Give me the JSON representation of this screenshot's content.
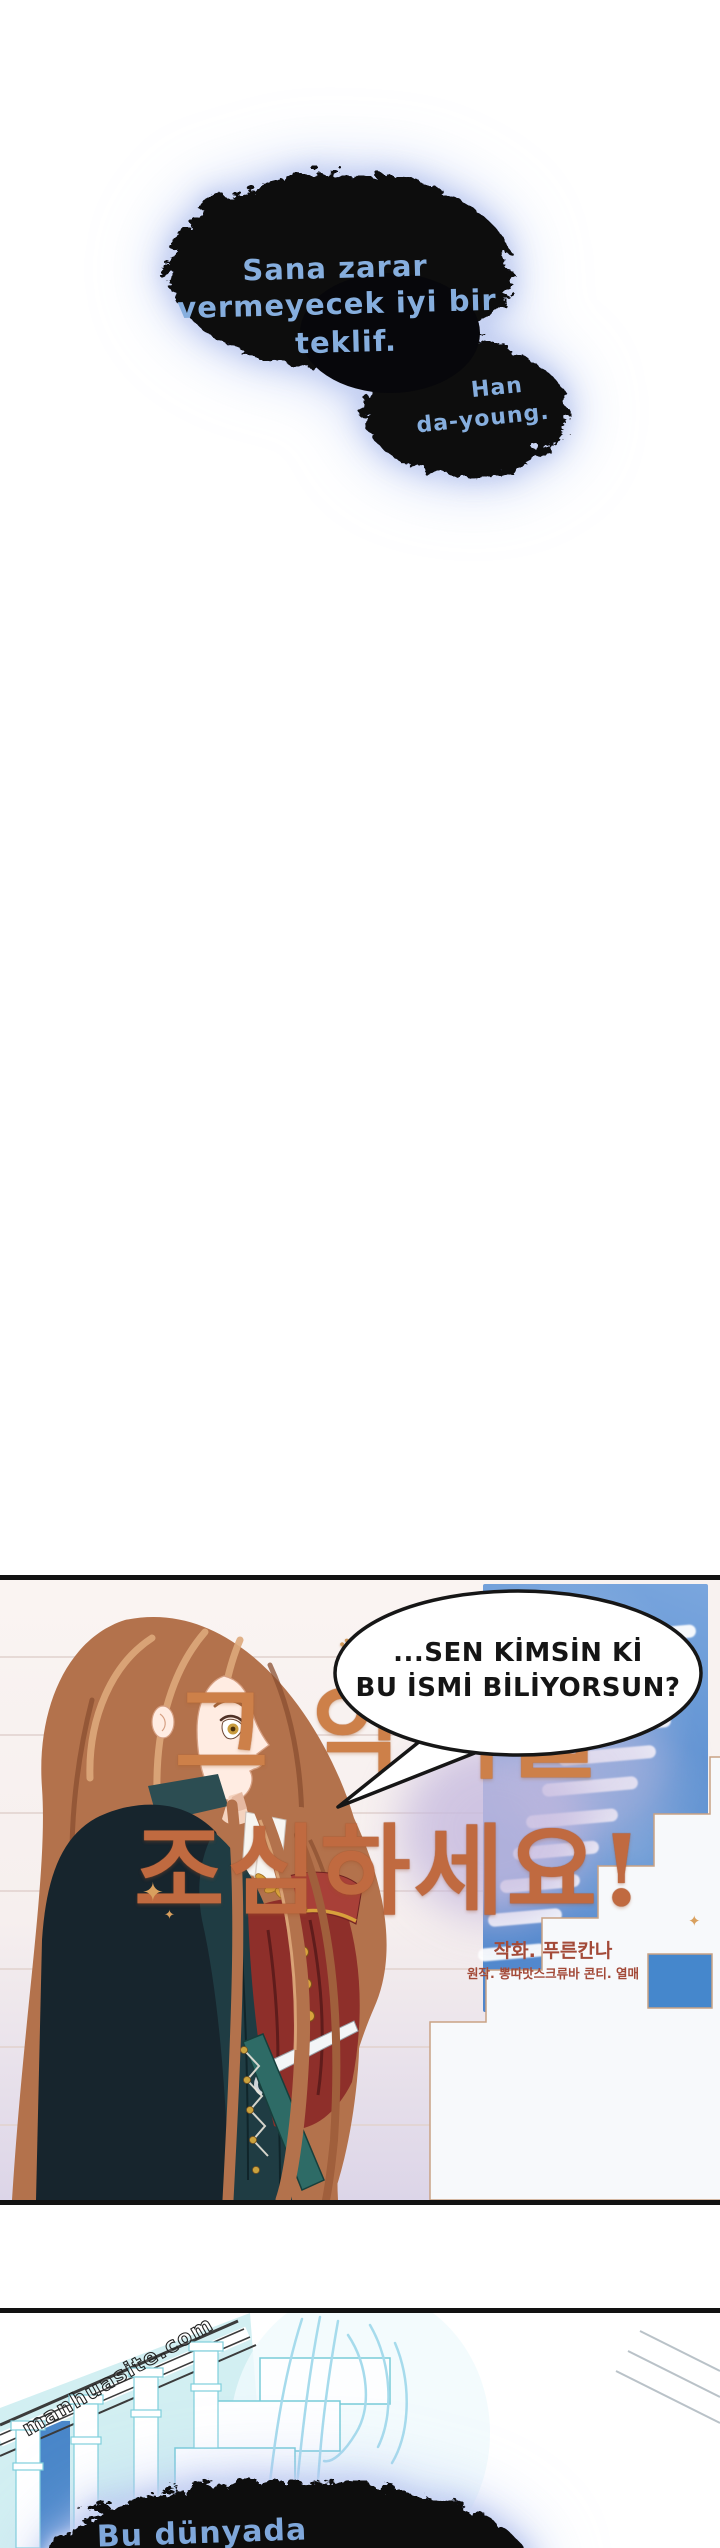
{
  "colors": {
    "bubble_text_blue": "#86aede",
    "bubble_black": "#07070b",
    "glow_blue": "#b9c6ee",
    "title_gold_light": "#e7b070",
    "title_gold_dark": "#b25c33",
    "credit_brown": "#a34a38",
    "stairwell_blue": "#5b8fd0",
    "step_outline_tan": "#c9a284",
    "lineart_cyan": "#79ccd8",
    "hair_auburn": "#b3724c"
  },
  "top_bubble": {
    "line1": "Sana zarar",
    "line2": "vermeyecek iyi bir",
    "line3": "teklif.",
    "speaker_line1": "Han",
    "speaker_line2": "da-young."
  },
  "title": {
    "crown_icon": "♛",
    "sparkle_icon": "✦",
    "line1": "그 악녀를",
    "line2": "조심하세요!",
    "credit_artist": "작화. 푸른칸나",
    "credit_original": "원작. 뽕따맛스크류바  콘티. 열매"
  },
  "panel1": {
    "bubble_line1": "...SEN KİMSİN Kİ",
    "bubble_line2": "BU İSMİ BİLİYORSUN?"
  },
  "panel2": {
    "watermark": "manhuasite.com",
    "bubble_text": "Bu dünyada"
  }
}
